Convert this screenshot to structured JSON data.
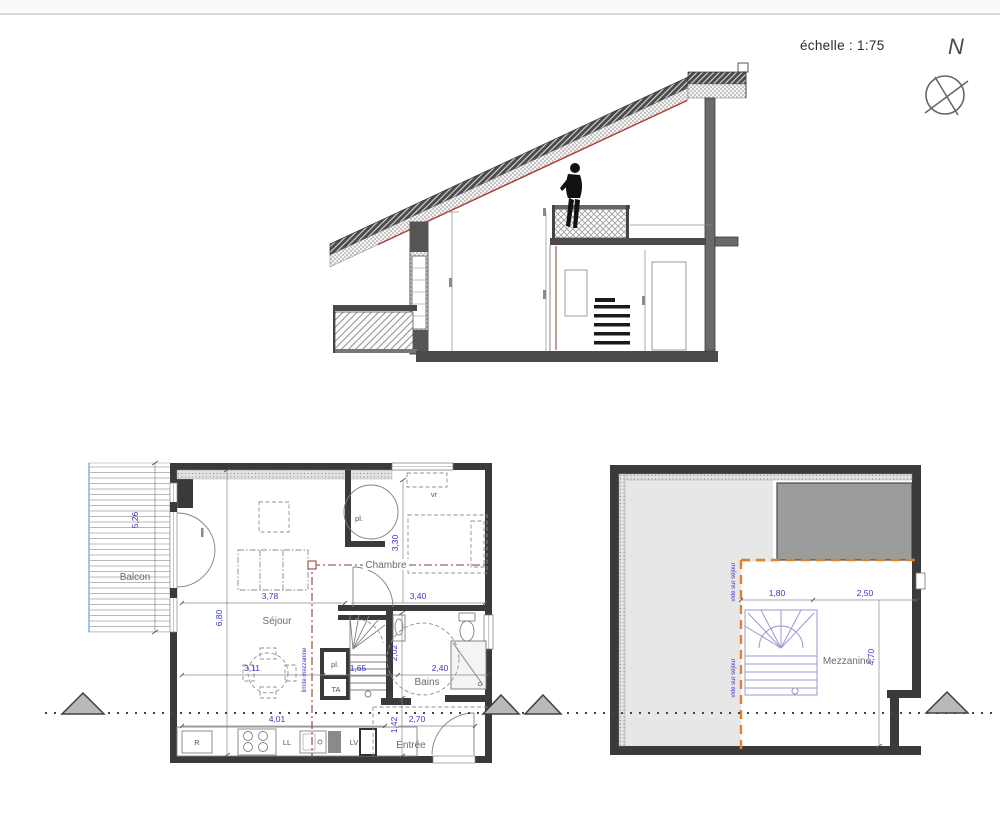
{
  "meta": {
    "scale_label": "échelle : 1:75",
    "north_letter": "N"
  },
  "colors": {
    "dim_blue": "#3a35c8",
    "red_line": "#8f3a32",
    "orange_line": "#e0812f",
    "wall_dark": "#3a3a3a",
    "balcony_blue": "#9fc5e8",
    "stairs_purple": "#9a98d2",
    "roof_red": "#b03a2e",
    "triangle_fill": "#b9b9b9"
  },
  "plan_lower": {
    "rooms": {
      "balcon": "Balcon",
      "sejour": "Séjour",
      "chambre": "Chambre",
      "bains": "Bains",
      "entree": "Entrée"
    },
    "labels": {
      "closet_top": "pl.",
      "closet_stairs": "pl.",
      "ta": "TA",
      "velux": "vr",
      "fridge": "R",
      "washer": "LL",
      "dishwasher": "LV",
      "mezzanine_edge": "limite mezzanine"
    },
    "dims": {
      "balcon_h": "5,26",
      "sejour_w": "3,78",
      "sejour_h": "6,80",
      "chambre_h": "3,30",
      "chambre_w": "3,40",
      "table_w": "3,11",
      "stairs_w": "1,65",
      "bains_h": "2,02",
      "bains_w": "2,40",
      "kitchen_w": "4,01",
      "entree_h": "1,42",
      "entree_w": "2,70"
    }
  },
  "plan_upper": {
    "room": "Mezzanine",
    "void_label_top": "vide sur séjour",
    "void_label_bottom": "vide sur séjour",
    "dims": {
      "w_left": "1,80",
      "w_right": "2,50",
      "h": "4,70"
    }
  }
}
